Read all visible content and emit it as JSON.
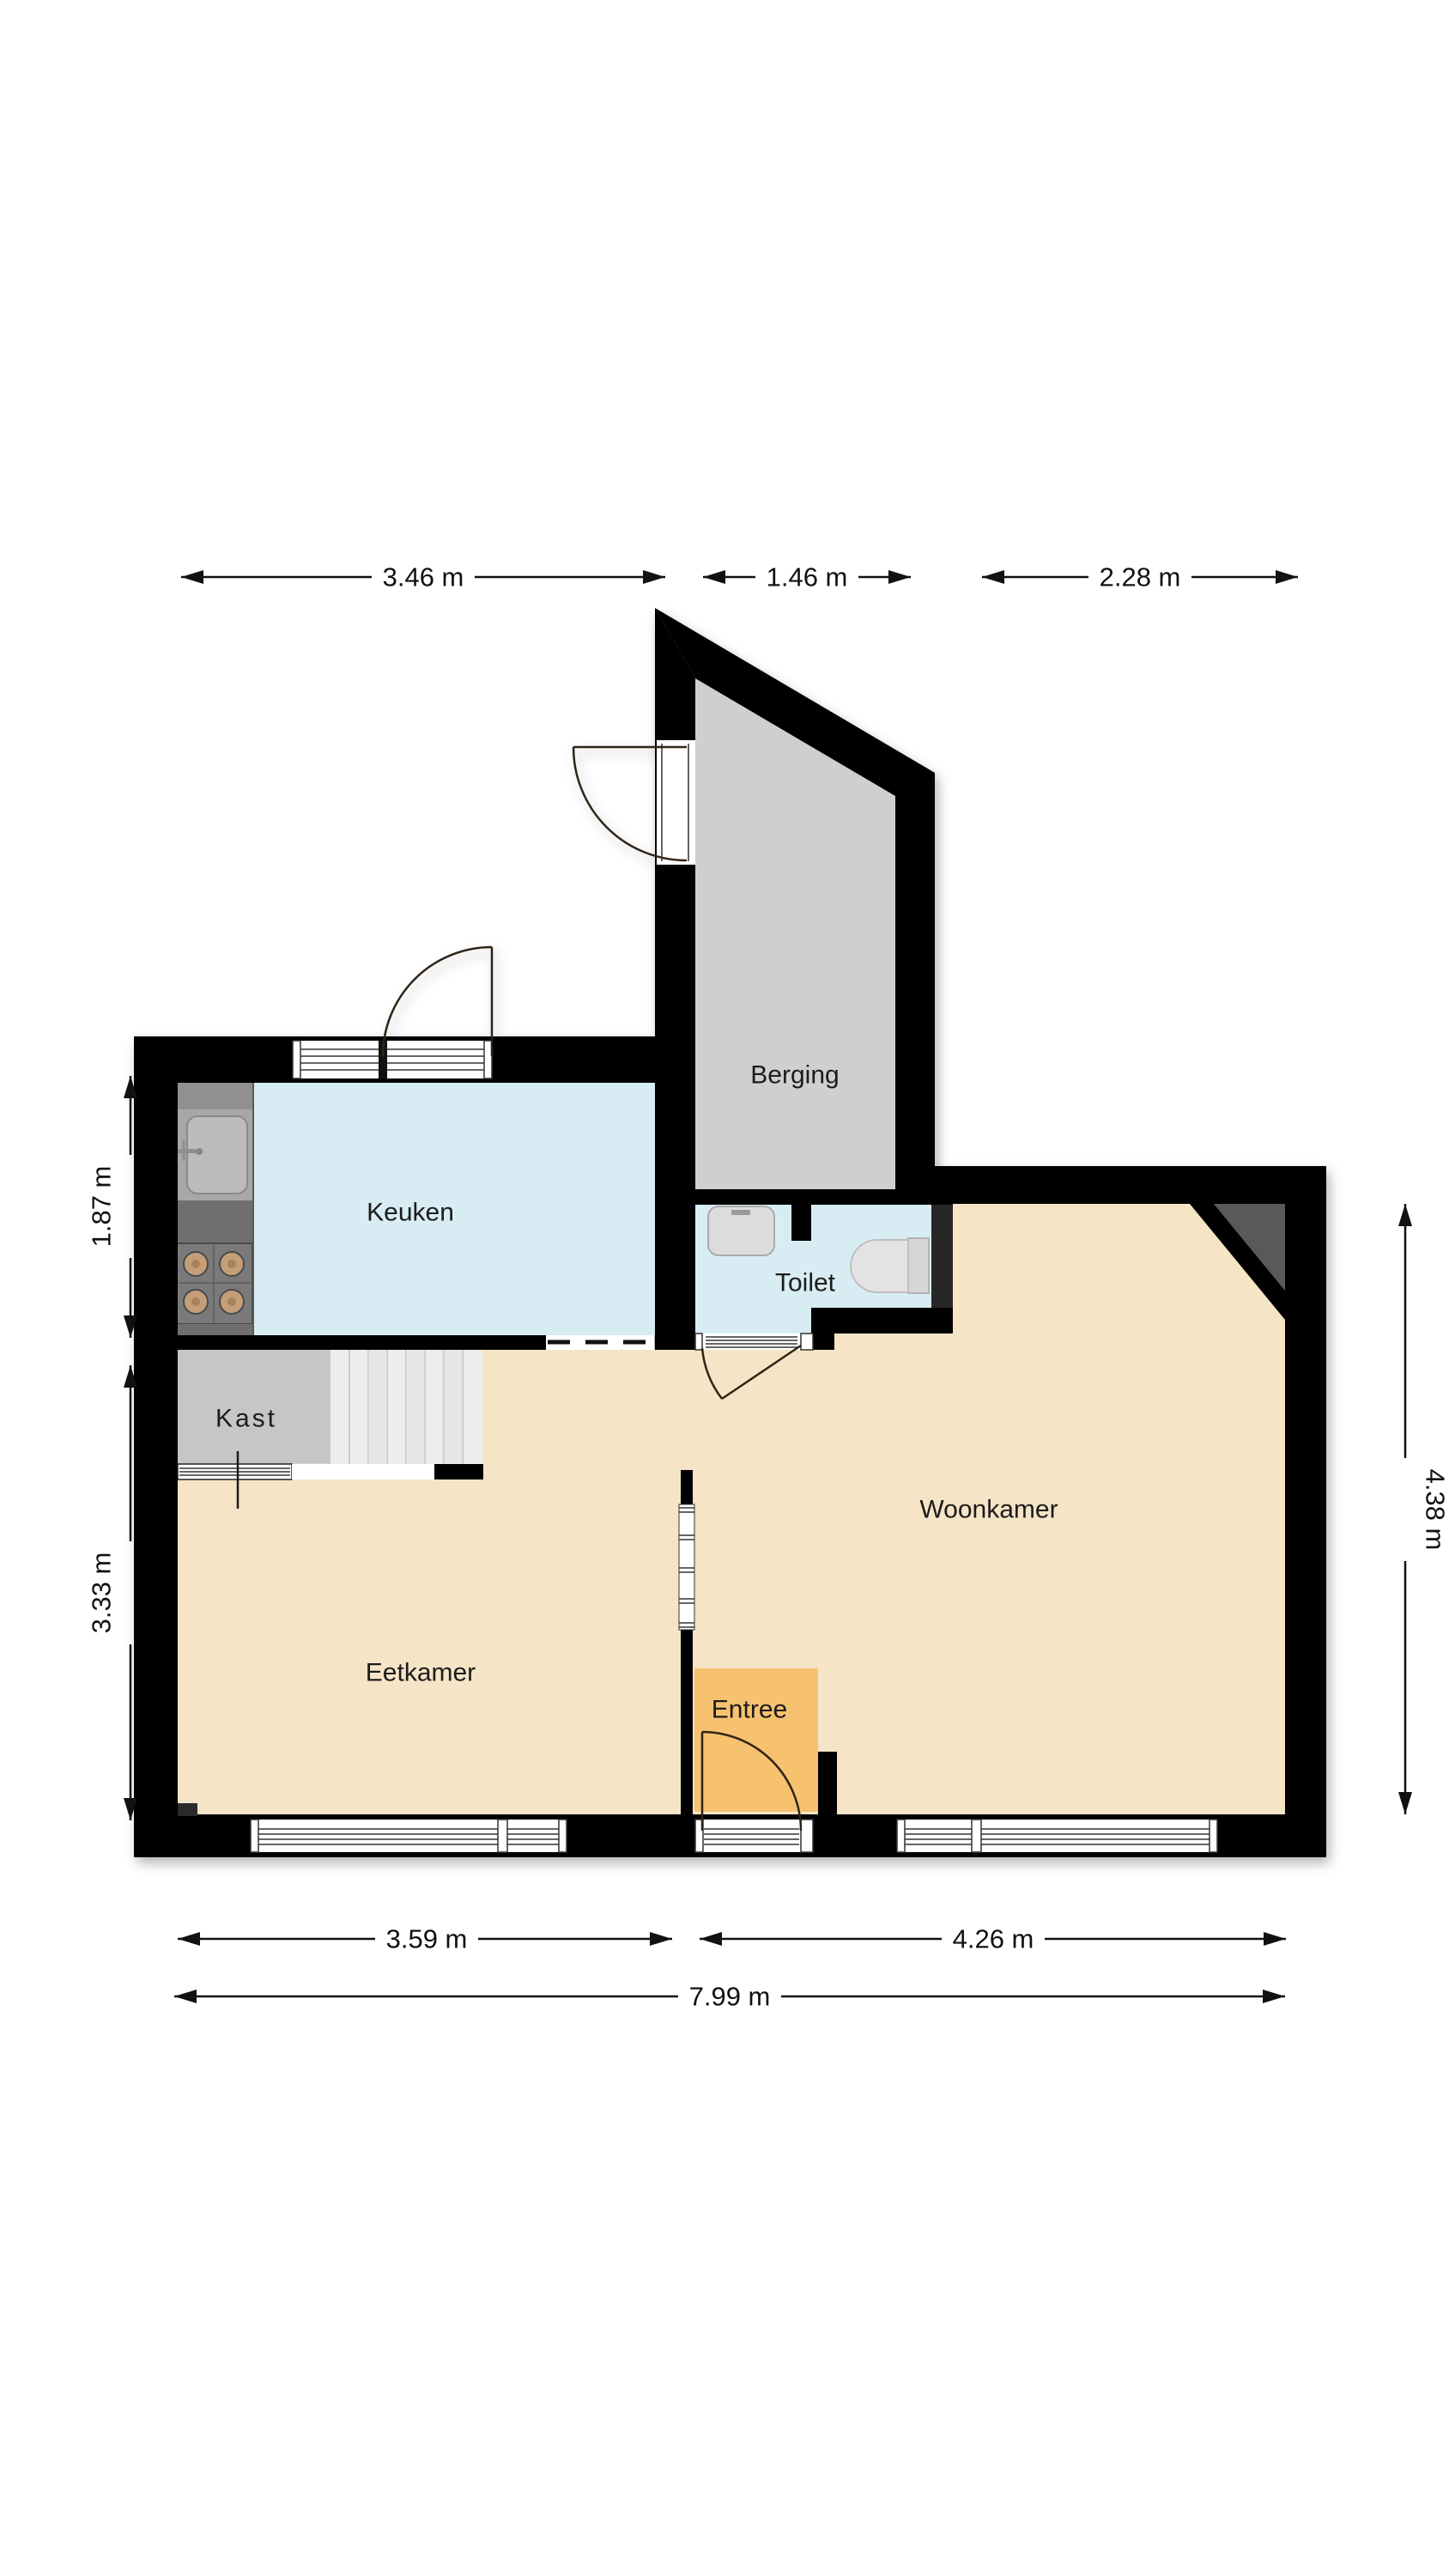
{
  "plan": {
    "title": "Floor plan",
    "colors": {
      "wall": "#000000",
      "keuken_floor": "#d8ecf3",
      "toilet_floor": "#d8ecf3",
      "berging_floor": "#cfcfcf",
      "kast_floor": "#c6c6c6",
      "living_floor": "#f6e4c6",
      "entree_floor": "#f7c26f",
      "stairs": "#ededed",
      "corner_shade": "#595959",
      "toilet_wall_block": "#262626",
      "counter_dark": "#6f6f6f",
      "counter_mid": "#909090",
      "sink_module": "#a7a7a7",
      "stove": "#7a7a7a",
      "burner": "#c49e78"
    },
    "rooms": {
      "berging": {
        "label": "Berging"
      },
      "keuken": {
        "label": "Keuken"
      },
      "toilet": {
        "label": "Toilet"
      },
      "kast": {
        "label": "Kast"
      },
      "eetkamer": {
        "label": "Eetkamer"
      },
      "woonkamer": {
        "label": "Woonkamer"
      },
      "entree": {
        "label": "Entree"
      }
    },
    "dimensions": {
      "top": [
        {
          "label": "3.46 m",
          "value_m": 3.46
        },
        {
          "label": "1.46 m",
          "value_m": 1.46
        },
        {
          "label": "2.28 m",
          "value_m": 2.28
        }
      ],
      "left": [
        {
          "label": "1.87 m",
          "value_m": 1.87
        },
        {
          "label": "3.33 m",
          "value_m": 3.33
        }
      ],
      "right": [
        {
          "label": "4.38 m",
          "value_m": 4.38
        }
      ],
      "bottom": [
        {
          "label": "3.59 m",
          "value_m": 3.59
        },
        {
          "label": "4.26 m",
          "value_m": 4.26
        }
      ],
      "total": [
        {
          "label": "7.99 m",
          "value_m": 7.99
        }
      ]
    }
  }
}
